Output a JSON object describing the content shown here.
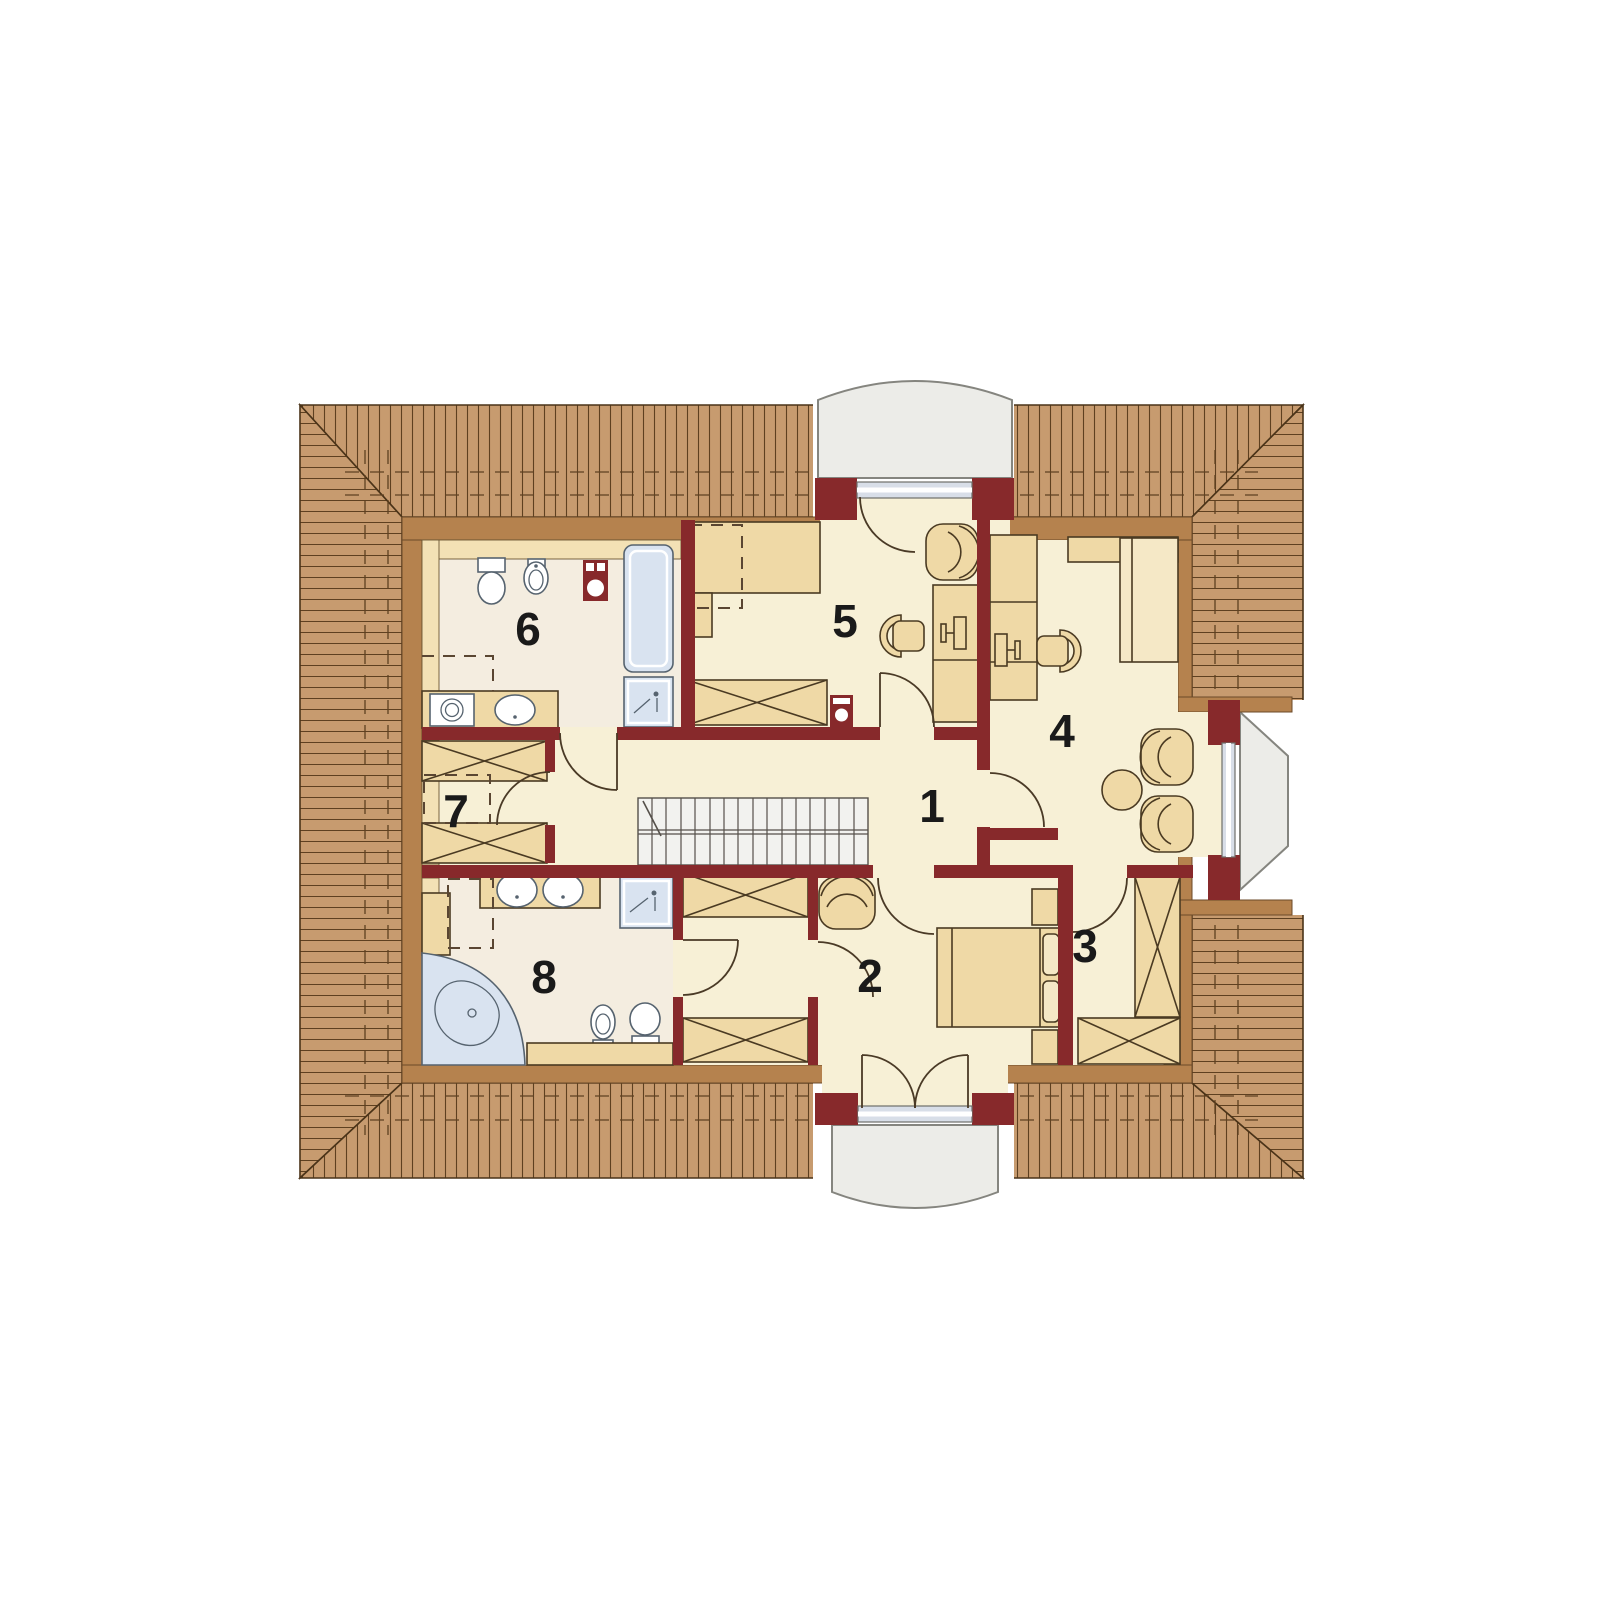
{
  "plan": {
    "type": "architectural-floor-plan",
    "rooms": [
      {
        "number": "1"
      },
      {
        "number": "2"
      },
      {
        "number": "3"
      },
      {
        "number": "4"
      },
      {
        "number": "5"
      },
      {
        "number": "6"
      },
      {
        "number": "7"
      },
      {
        "number": "8"
      }
    ],
    "colors": {
      "roof": "#C79B6F",
      "roof_hatch": "#5E4020",
      "roof_inner_band": "#B5824E",
      "wall": "#87292B",
      "floor": "#F7F0D6",
      "bath_floor": "#F4EDE0",
      "furniture": "#EFD9A6",
      "furniture_light": "#F5E8C6",
      "knee_strip": "#F3E1B5",
      "fixture_blue": "#D9E3F0",
      "balcony": "#ECECE8",
      "stairs": "#F2F2EF",
      "label": "#1A1A1A",
      "background": "#FFFFFF"
    }
  }
}
